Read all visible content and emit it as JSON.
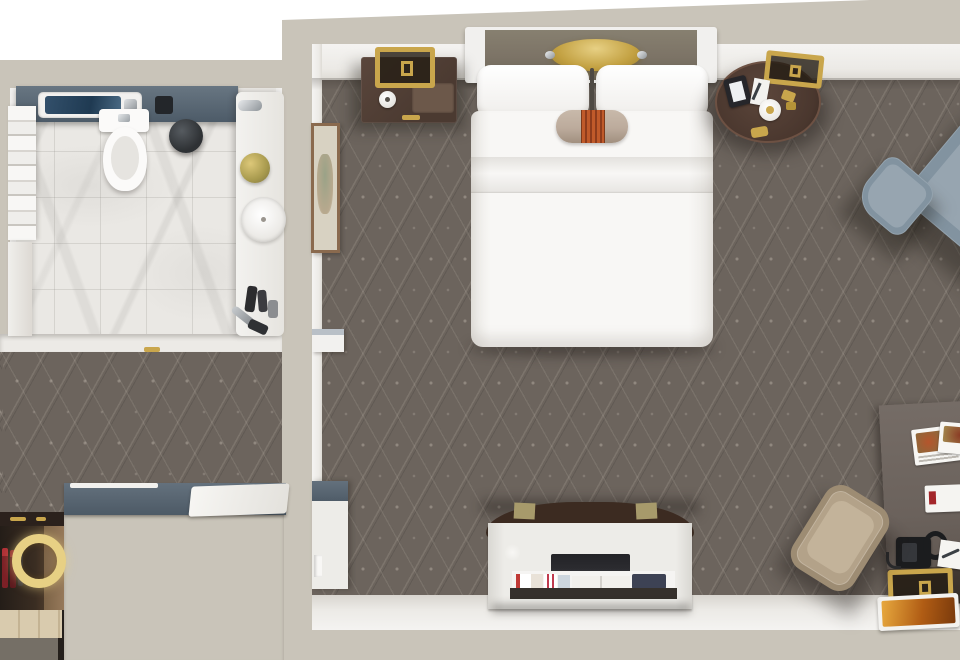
{
  "scene": {
    "type": "3d-floor-plan-top-down-render",
    "setting": "hotel-guest-room-with-bathroom",
    "rooms": [
      {
        "name": "bathroom",
        "items": [
          "slate-vanity-counter",
          "inset-sink",
          "chrome-faucet",
          "black-accessory",
          "toilet",
          "round-stool",
          "towel-shelving",
          "side-panel",
          "marble-counter",
          "vessel-sink",
          "flower-posy",
          "toiletries",
          "marble-tile-floor"
        ]
      },
      {
        "name": "entry-dressing-area",
        "items": [
          "patterned-carpet",
          "slate-wardrobe-counter",
          "white-bench-pad",
          "minibar-cabinet",
          "illuminated-ring-mirror",
          "minibar-bottles",
          "wood-shelf",
          "door-hinge"
        ]
      },
      {
        "name": "bedroom",
        "items": [
          "patterned-carpet",
          "framed-artwork",
          "door-jamb",
          "entry-closet-panel",
          "headboard",
          "gold-pendant-light",
          "pillow-left",
          "pillow-right",
          "bolster-pillow",
          "duvet",
          "nightstand",
          "gold-frame-lamp",
          "alarm-clock",
          "tray",
          "round-side-table",
          "gold-frame-table-lamp",
          "tablet",
          "notepad",
          "trinket-dish",
          "lounge-chair",
          "ottoman",
          "tv-credenza",
          "luggage-straps",
          "television",
          "magazine-shelf",
          "desk",
          "desk-chair",
          "telephone",
          "handset",
          "menu-cards",
          "letter",
          "pen",
          "gold-desk-lamp",
          "serving-tray"
        ]
      }
    ],
    "colors": {
      "wall-beige": "#c9c4b9",
      "wall-face": "#f1f0ee",
      "carpet": "#6c645d",
      "marble": "#eae8e4",
      "slate": "#5b6874",
      "slate-dark": "#46535f",
      "bed-white": "#f8f7f5",
      "headboard": "#7c7366",
      "gold": "#c9a64c",
      "gold-bright": "#e7d084",
      "wood-dark": "#4b3a31",
      "table-wood": "#4a372e",
      "chair-slate": "#8293a0",
      "chair-slate-light": "#97a5b0",
      "desk-top": "#6b625c",
      "desk-front": "#332c26",
      "desk-chair-beige": "#b3a289",
      "bolster": "#bcab9c",
      "bolster-band": "#c05a2a",
      "credenza-white": "#edece8",
      "tv-dark": "#2b2b2f",
      "credenza-wood": "#3c2b21",
      "minibar-wood": "#96795a",
      "shelf-wood": "#d9cbae",
      "bottle-red": "#7c2026",
      "art-frame": "#8a6a4e",
      "toilet-white": "#fbfaf9"
    }
  }
}
